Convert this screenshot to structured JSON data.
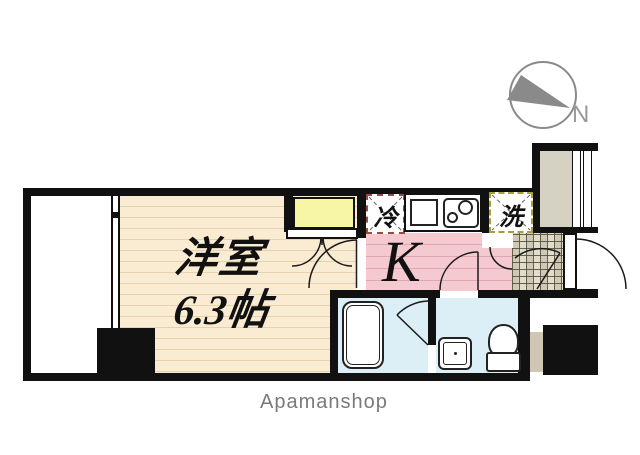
{
  "plan": {
    "room": {
      "name": "洋室",
      "size": "6.3帖"
    },
    "kitchen": {
      "label": "K"
    },
    "refrigerator": {
      "label": "冷"
    },
    "washer": {
      "label": "洗"
    },
    "compass": {
      "label": "N"
    },
    "footer": {
      "brand": "Apamanshop"
    },
    "colors": {
      "wall": "#111111",
      "room_floor": "#faecd2",
      "kitchen_floor": "#f5c9d0",
      "closet": "#f6f6a4",
      "bath": "#dceef6",
      "alcove": "#d5d1c3",
      "genkan_tile": "#d8d2c0",
      "refrigerator_dash": "#9b4a42",
      "washer_dash": "#a6a13a",
      "compass_gray": "#8a8a8a",
      "brand_gray": "#7a7a7a"
    }
  }
}
